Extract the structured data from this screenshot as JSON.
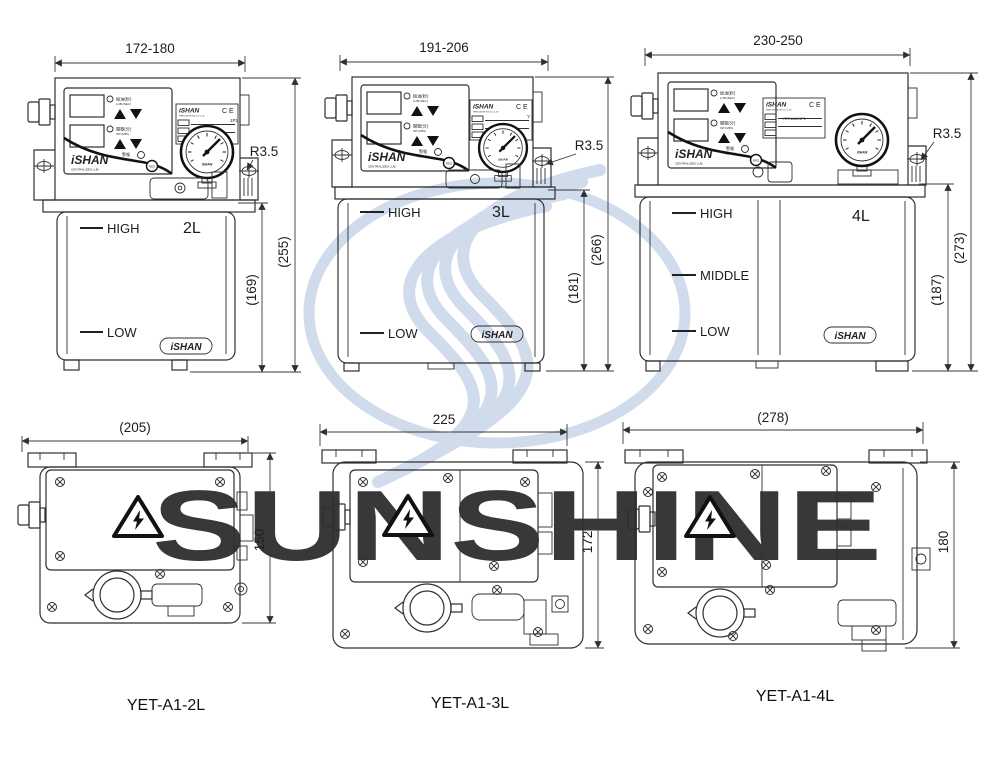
{
  "drawing_title": "YET-A1 centralized lubrication pump dimension drawing",
  "watermark": {
    "brand": "SUNSHINE",
    "color": "#b7c6dc",
    "logo": "sunshine-s-swirl"
  },
  "icons": {
    "hazard": "high-voltage-triangle",
    "screw": "cross-slot-screw",
    "gauge": "pressure-gauge",
    "ce": "ce-mark"
  },
  "panel": {
    "brand": "iSHAN",
    "brand_sub": "CENTRALIZED LUB.",
    "lub_cn": "給油(秒)",
    "lub_en": "LUB.(SEC)",
    "int_cn": "間歇(分)",
    "int_en": "INT.(MIN)",
    "alarm_cn": "警報",
    "alarm_en": "ALARM",
    "reset": "RES"
  },
  "nameplate": {
    "brand": "iSHAN",
    "company": "PRECISION IND.CO.,LTD",
    "ce": "CE"
  },
  "gauge_brand": "iSHAN",
  "tank_badge": "iSHAN",
  "units": [
    {
      "model": "YET-A1-2L",
      "capacity": "2L",
      "plate_model": "1P1",
      "front": {
        "width": "172-180",
        "overall_height": "(255)",
        "body_height": "(169)",
        "fillet": "R3.5",
        "level_high": "HIGH",
        "level_low": "LOW"
      },
      "top": {
        "width": "(205)",
        "depth": "150"
      }
    },
    {
      "model": "YET-A1-3L",
      "capacity": "3L",
      "plate_model": "Y",
      "front": {
        "width": "191-206",
        "overall_height": "(266)",
        "body_height": "(181)",
        "fillet": "R3.5",
        "level_high": "HIGH",
        "level_low": "LOW"
      },
      "top": {
        "width": "225",
        "depth": "172"
      }
    },
    {
      "model": "YET-A1-4L",
      "capacity": "4L",
      "plate_model": "YET-A1A/1P1",
      "front": {
        "width": "230-250",
        "overall_height": "(273)",
        "body_height": "(187)",
        "fillet": "R3.5",
        "level_high": "HIGH",
        "level_middle": "MIDDLE",
        "level_low": "LOW"
      },
      "top": {
        "width": "(278)",
        "depth": "180"
      }
    }
  ]
}
